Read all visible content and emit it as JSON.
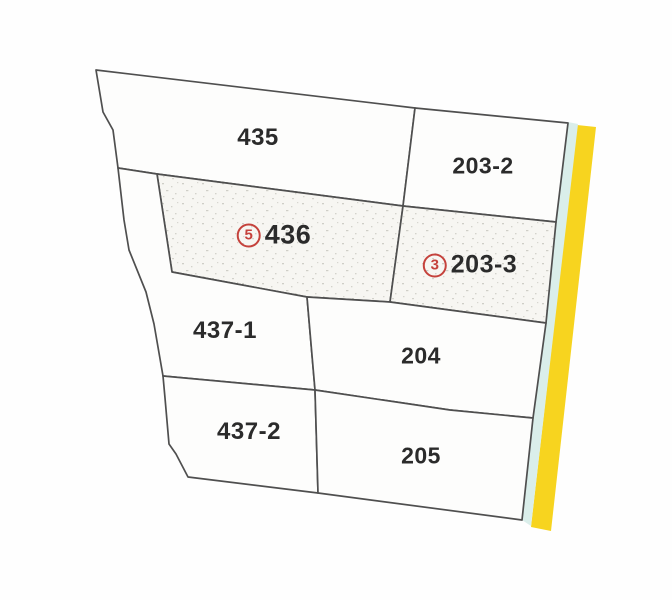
{
  "map": {
    "type": "cadastral-parcel-map",
    "colors": {
      "background": "#fefefe",
      "parcel_fill": "#fdfdfc",
      "hatched_fill": "#f7f6f2",
      "hatch_dot": "#c9c8c1",
      "boundary_stroke": "#4f4f4f",
      "road_yellow": "#f7d41f",
      "edge_strip_cyan": "#daeeea",
      "label_text": "#2b2b2b",
      "badge_red": "#c5423c"
    },
    "road_strip": {
      "name": "road-strip",
      "points": "577,125 596,127 551,531 531,527"
    },
    "edge_strip": {
      "name": "cyan-edge-strip",
      "points": "568,122 578,124 531,526 522,520"
    },
    "parcels": [
      {
        "id": "435",
        "label": "435",
        "badge": null,
        "hatched": false,
        "points": "96,70 415,108 403,206 157,174 118,168 113,130 103,112",
        "label_x": 258,
        "label_y": 138,
        "label_font": 24
      },
      {
        "id": "203-2",
        "label": "203-2",
        "badge": null,
        "hatched": false,
        "points": "415,108 568,123 556,222 403,206",
        "label_x": 483,
        "label_y": 166,
        "label_font": 23
      },
      {
        "id": "436",
        "label": "436",
        "badge": "5",
        "hatched": true,
        "points": "157,174 403,206 390,302 307,297 172,272",
        "label_x": 274,
        "label_y": 235,
        "label_font": 27
      },
      {
        "id": "203-3",
        "label": "203-3",
        "badge": "3",
        "hatched": true,
        "points": "403,206 556,222 546,323 390,302",
        "label_x": 470,
        "label_y": 265,
        "label_font": 25
      },
      {
        "id": "437-1",
        "label": "437-1",
        "badge": null,
        "hatched": false,
        "points": "157,174 172,272 307,297 315,390 163,376 154,324 146,292 129,250 124,220 118,168",
        "label_x": 225,
        "label_y": 331,
        "label_font": 24
      },
      {
        "id": "204",
        "label": "204",
        "badge": null,
        "hatched": false,
        "points": "307,297 390,302 546,323 533,418 450,410 315,390",
        "label_x": 421,
        "label_y": 356,
        "label_font": 23
      },
      {
        "id": "437-2",
        "label": "437-2",
        "badge": null,
        "hatched": false,
        "points": "163,376 315,390 318,493 188,477 176,454 169,444 165,398",
        "label_x": 249,
        "label_y": 432,
        "label_font": 24
      },
      {
        "id": "205",
        "label": "205",
        "badge": null,
        "hatched": false,
        "points": "315,390 450,410 533,418 522,520 318,493",
        "label_x": 421,
        "label_y": 456,
        "label_font": 23
      }
    ]
  }
}
